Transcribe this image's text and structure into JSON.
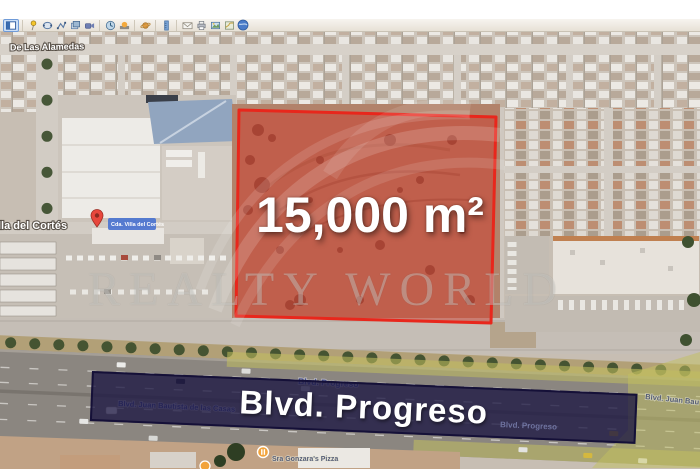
{
  "app": {
    "name": "google-earth"
  },
  "toolbar": {
    "icons": [
      "sidebar-toggle",
      "add-placemark",
      "add-polygon",
      "add-path",
      "add-image-overlay",
      "record-tour",
      "historical-imagery",
      "sunlight",
      "planets",
      "ruler",
      "email",
      "print",
      "save-image",
      "view-in-maps",
      "globe"
    ]
  },
  "listing": {
    "area_label": "15,000 m²",
    "boulevard_banner": "Blvd. Progreso",
    "watermark": "REALTY WORLD"
  },
  "map_labels": {
    "street_top": "De Las Alamedas",
    "street_left": "lla del Cortés",
    "pin_box": "Cda. Villa del Cortés",
    "road_top_small": "Blvd. Progreso",
    "road_juan_bautista": "Blvd. Juan Bautista de las Casas",
    "road_bottom_small": "Blvd. Progreso",
    "road_right_edge": "Blvd. Juan Bau",
    "poi_pizza": "Sra Gonzara's Pizza"
  },
  "colors": {
    "parcel_stroke": "#e8271c",
    "parcel_fill": "rgba(205,60,45,0.5)",
    "banner_bg": "rgba(28,23,66,0.78)",
    "route_highlight": "#c2c05f",
    "pin": "#e8473c",
    "poi": "#f2a33b"
  }
}
